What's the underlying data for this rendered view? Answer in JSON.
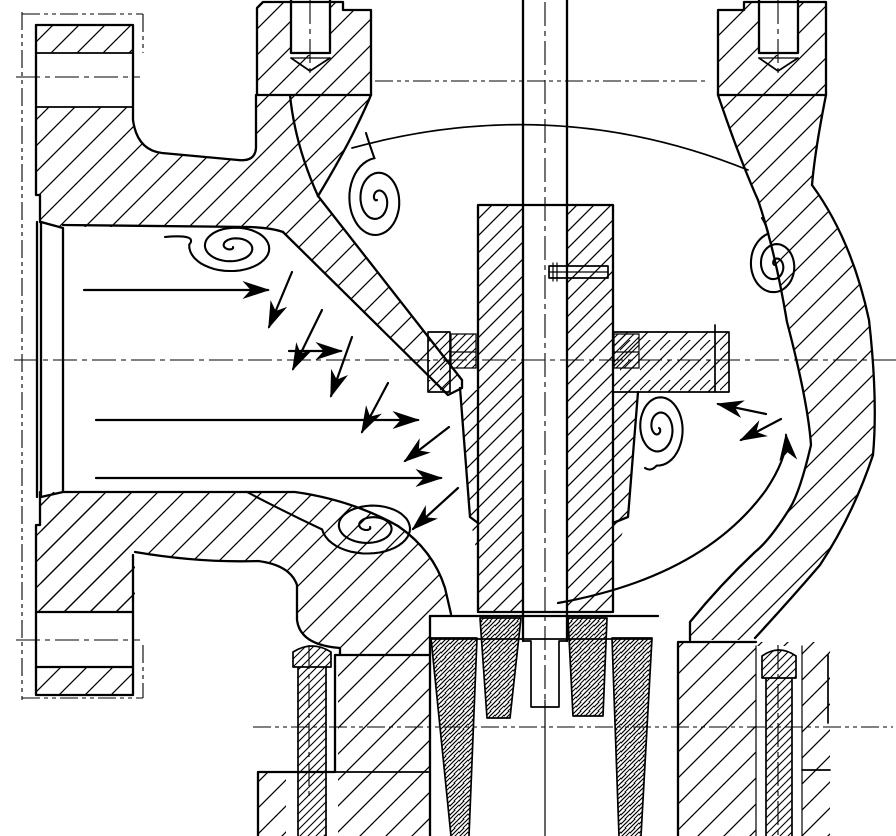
{
  "document": {
    "type": "technical-drawing",
    "title": "Globe control valve cross-section with flow pattern",
    "description": "Sectional engineering drawing of a flanged globe-style control valve. Flow enters the left inlet bore, is deflected downward along the inclined seat partition past the contoured plug, and turns upward through the right outlet chamber. Turbulence vortices are sketched in the dead zones. No text appears in the drawing."
  },
  "drawing": {
    "background": "#ffffff",
    "line_color": "#000000",
    "canvas": {
      "width": 896,
      "height": 836
    }
  },
  "components": [
    "inlet-flange",
    "inlet-bore",
    "valve-body",
    "seat-partition",
    "bonnet-flange-left",
    "bonnet-flange-right",
    "tapped-bolt-holes",
    "valve-stem",
    "valve-plug",
    "plug-pin",
    "seat-seal-rings",
    "guide-wing-left",
    "guide-arm-right",
    "outlet-chamber",
    "packing-columns",
    "bottom-studs",
    "bottom-flange",
    "centerlines",
    "phantom-lines"
  ],
  "flow": {
    "inlet_arrows": [
      {
        "x1": 84,
        "y1": 290,
        "x2": 268,
        "y2": 290
      },
      {
        "x1": 289,
        "y1": 351,
        "x2": 341,
        "y2": 351
      },
      {
        "x1": 96,
        "y1": 420,
        "x2": 418,
        "y2": 420
      },
      {
        "x1": 96,
        "y1": 478,
        "x2": 441,
        "y2": 478
      }
    ],
    "deflection_arrows": [
      {
        "x1": 292,
        "y1": 272,
        "x2": 269,
        "y2": 327
      },
      {
        "x1": 322,
        "y1": 310,
        "x2": 293,
        "y2": 369
      },
      {
        "x1": 352,
        "y1": 337,
        "x2": 331,
        "y2": 396
      },
      {
        "x1": 388,
        "y1": 383,
        "x2": 362,
        "y2": 432
      },
      {
        "x1": 449,
        "y1": 427,
        "x2": 405,
        "y2": 461
      },
      {
        "x1": 458,
        "y1": 488,
        "x2": 413,
        "y2": 529
      }
    ],
    "outlet_arrows": [
      {
        "x1": 766,
        "y1": 414,
        "x2": 718,
        "y2": 404
      },
      {
        "x1": 781,
        "y1": 419,
        "x2": 741,
        "y2": 440
      }
    ],
    "outlet_curve": {
      "d": "M558,603 Q703,577 766,490 Q788,457 786,435"
    },
    "vortices": [
      {
        "cx": 233,
        "cy": 247,
        "r": 44,
        "aspect": 0.6,
        "end": 185,
        "turns": 2.3,
        "tail": {
          "qx": 198,
          "qy": 234,
          "x": 165,
          "y": 237
        }
      },
      {
        "cx": 377,
        "cy": 200,
        "r": 30,
        "aspect": 1.4,
        "end": 265,
        "turns": 2.3,
        "tail": {
          "qx": 369,
          "qy": 143,
          "x": 366,
          "y": 133
        }
      },
      {
        "cx": 775,
        "cy": 265,
        "r": 26,
        "aspect": 1.25,
        "end": 255,
        "turns": 2.2,
        "tail": {
          "qx": 766,
          "qy": 224,
          "x": 762,
          "y": 218
        }
      },
      {
        "cx": 659,
        "cy": 428,
        "r": 26,
        "aspect": 1.45,
        "end": 95,
        "turns": 2.2,
        "tail": {
          "qx": 651,
          "qy": 472,
          "x": 645,
          "y": 468
        }
      },
      {
        "cx": 370,
        "cy": 527,
        "r": 48,
        "aspect": 0.6,
        "end": 175,
        "turns": 2.3,
        "tail": {
          "qx": 285,
          "qy": 512,
          "x": 247,
          "y": 492
        }
      }
    ]
  }
}
